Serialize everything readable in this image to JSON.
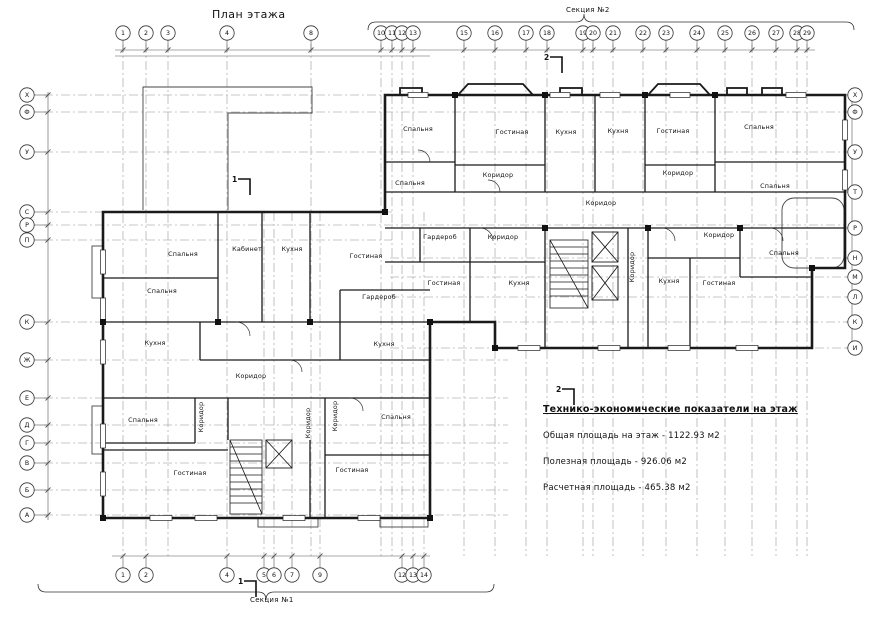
{
  "page": {
    "title": "План этажа"
  },
  "sections": {
    "top_label": "Секция №2",
    "bottom_label": "Секция №1"
  },
  "tep": {
    "title": "Технико-экономические показатели на этаж",
    "lines": [
      "Общая площадь на этаж - 1122.93 м2",
      "Полезная площадь - 926.06  м2",
      "Расчетная площадь - 465.38  м2"
    ]
  },
  "axes": {
    "top": [
      [
        "1",
        123
      ],
      [
        "2",
        146
      ],
      [
        "3",
        168
      ],
      [
        "4",
        227
      ],
      [
        "8",
        311
      ],
      [
        "10",
        381
      ],
      [
        "11",
        392
      ],
      [
        "12",
        402
      ],
      [
        "13",
        413
      ],
      [
        "15",
        464
      ],
      [
        "16",
        495
      ],
      [
        "17",
        526
      ],
      [
        "18",
        547
      ],
      [
        "19",
        583
      ],
      [
        "20",
        593
      ],
      [
        "21",
        613
      ],
      [
        "22",
        643
      ],
      [
        "23",
        666
      ],
      [
        "24",
        697
      ],
      [
        "25",
        725
      ],
      [
        "26",
        752
      ],
      [
        "27",
        776
      ],
      [
        "28",
        797
      ],
      [
        "29",
        807
      ]
    ],
    "bottom": [
      [
        "1",
        123
      ],
      [
        "2",
        146
      ],
      [
        "4",
        227
      ],
      [
        "5",
        264
      ],
      [
        "6",
        274
      ],
      [
        "7",
        292
      ],
      [
        "9",
        320
      ],
      [
        "12",
        402
      ],
      [
        "13",
        413
      ],
      [
        "14",
        424
      ]
    ],
    "left": [
      [
        "Х",
        95
      ],
      [
        "Ф",
        112
      ],
      [
        "У",
        152
      ],
      [
        "С",
        212
      ],
      [
        "Р",
        225
      ],
      [
        "П",
        240
      ],
      [
        "К",
        322
      ],
      [
        "Ж",
        360
      ],
      [
        "Е",
        398
      ],
      [
        "Д",
        425
      ],
      [
        "Г",
        443
      ],
      [
        "В",
        463
      ],
      [
        "Б",
        490
      ],
      [
        "А",
        515
      ]
    ],
    "right": [
      [
        "Х",
        95
      ],
      [
        "Ф",
        112
      ],
      [
        "У",
        152
      ],
      [
        "Т",
        192
      ],
      [
        "Р",
        228
      ],
      [
        "Н",
        258
      ],
      [
        "М",
        277
      ],
      [
        "Л",
        297
      ],
      [
        "К",
        322
      ],
      [
        "И",
        348
      ]
    ]
  },
  "rooms": [
    [
      "Спальня",
      183,
      256,
      0
    ],
    [
      "Кабинет",
      247,
      251,
      0
    ],
    [
      "Кухня",
      292,
      251,
      0
    ],
    [
      "Гостиная",
      366,
      258,
      0
    ],
    [
      "Спальня",
      162,
      293,
      0
    ],
    [
      "Гардероб",
      379,
      299,
      0
    ],
    [
      "Кухня",
      155,
      345,
      0
    ],
    [
      "Кухня",
      384,
      346,
      0
    ],
    [
      "Коридор",
      251,
      378,
      0
    ],
    [
      "Спальня",
      143,
      422,
      0
    ],
    [
      "Коридор",
      203,
      417,
      1
    ],
    [
      "Коридор",
      310,
      423,
      1
    ],
    [
      "Коридор",
      337,
      416,
      1
    ],
    [
      "Спальня",
      396,
      419,
      0
    ],
    [
      "Гостиная",
      190,
      475,
      0
    ],
    [
      "Гостиная",
      352,
      472,
      0
    ],
    [
      "Спальня",
      418,
      131,
      0
    ],
    [
      "Гостиная",
      512,
      134,
      0
    ],
    [
      "Кухня",
      566,
      134,
      0
    ],
    [
      "Кухня",
      618,
      133,
      0
    ],
    [
      "Гостиная",
      673,
      133,
      0
    ],
    [
      "Спальня",
      759,
      129,
      0
    ],
    [
      "Спальня",
      410,
      185,
      0
    ],
    [
      "Коридор",
      498,
      177,
      0
    ],
    [
      "Коридор",
      678,
      175,
      0
    ],
    [
      "Спальня",
      775,
      188,
      0
    ],
    [
      "Коридор",
      601,
      205,
      0
    ],
    [
      "Гардероб",
      440,
      239,
      0
    ],
    [
      "Коридор",
      503,
      239,
      0
    ],
    [
      "Коридор",
      719,
      237,
      0
    ],
    [
      "Гостиная",
      444,
      285,
      0
    ],
    [
      "Кухня",
      519,
      285,
      0
    ],
    [
      "Коридор",
      634,
      267,
      1
    ],
    [
      "Кухня",
      669,
      283,
      0
    ],
    [
      "Гостиная",
      719,
      285,
      0
    ],
    [
      "Спальня",
      784,
      255,
      0
    ]
  ],
  "section_cuts": [
    {
      "label": "2",
      "x": 544,
      "y": 60
    },
    {
      "label": "2",
      "x": 556,
      "y": 392
    },
    {
      "label": "1",
      "x": 232,
      "y": 182
    },
    {
      "label": "1",
      "x": 238,
      "y": 584
    }
  ],
  "colors": {
    "wall": "#1a1a1a",
    "grid": "#909090",
    "text": "#111111",
    "dim": "#555555"
  }
}
